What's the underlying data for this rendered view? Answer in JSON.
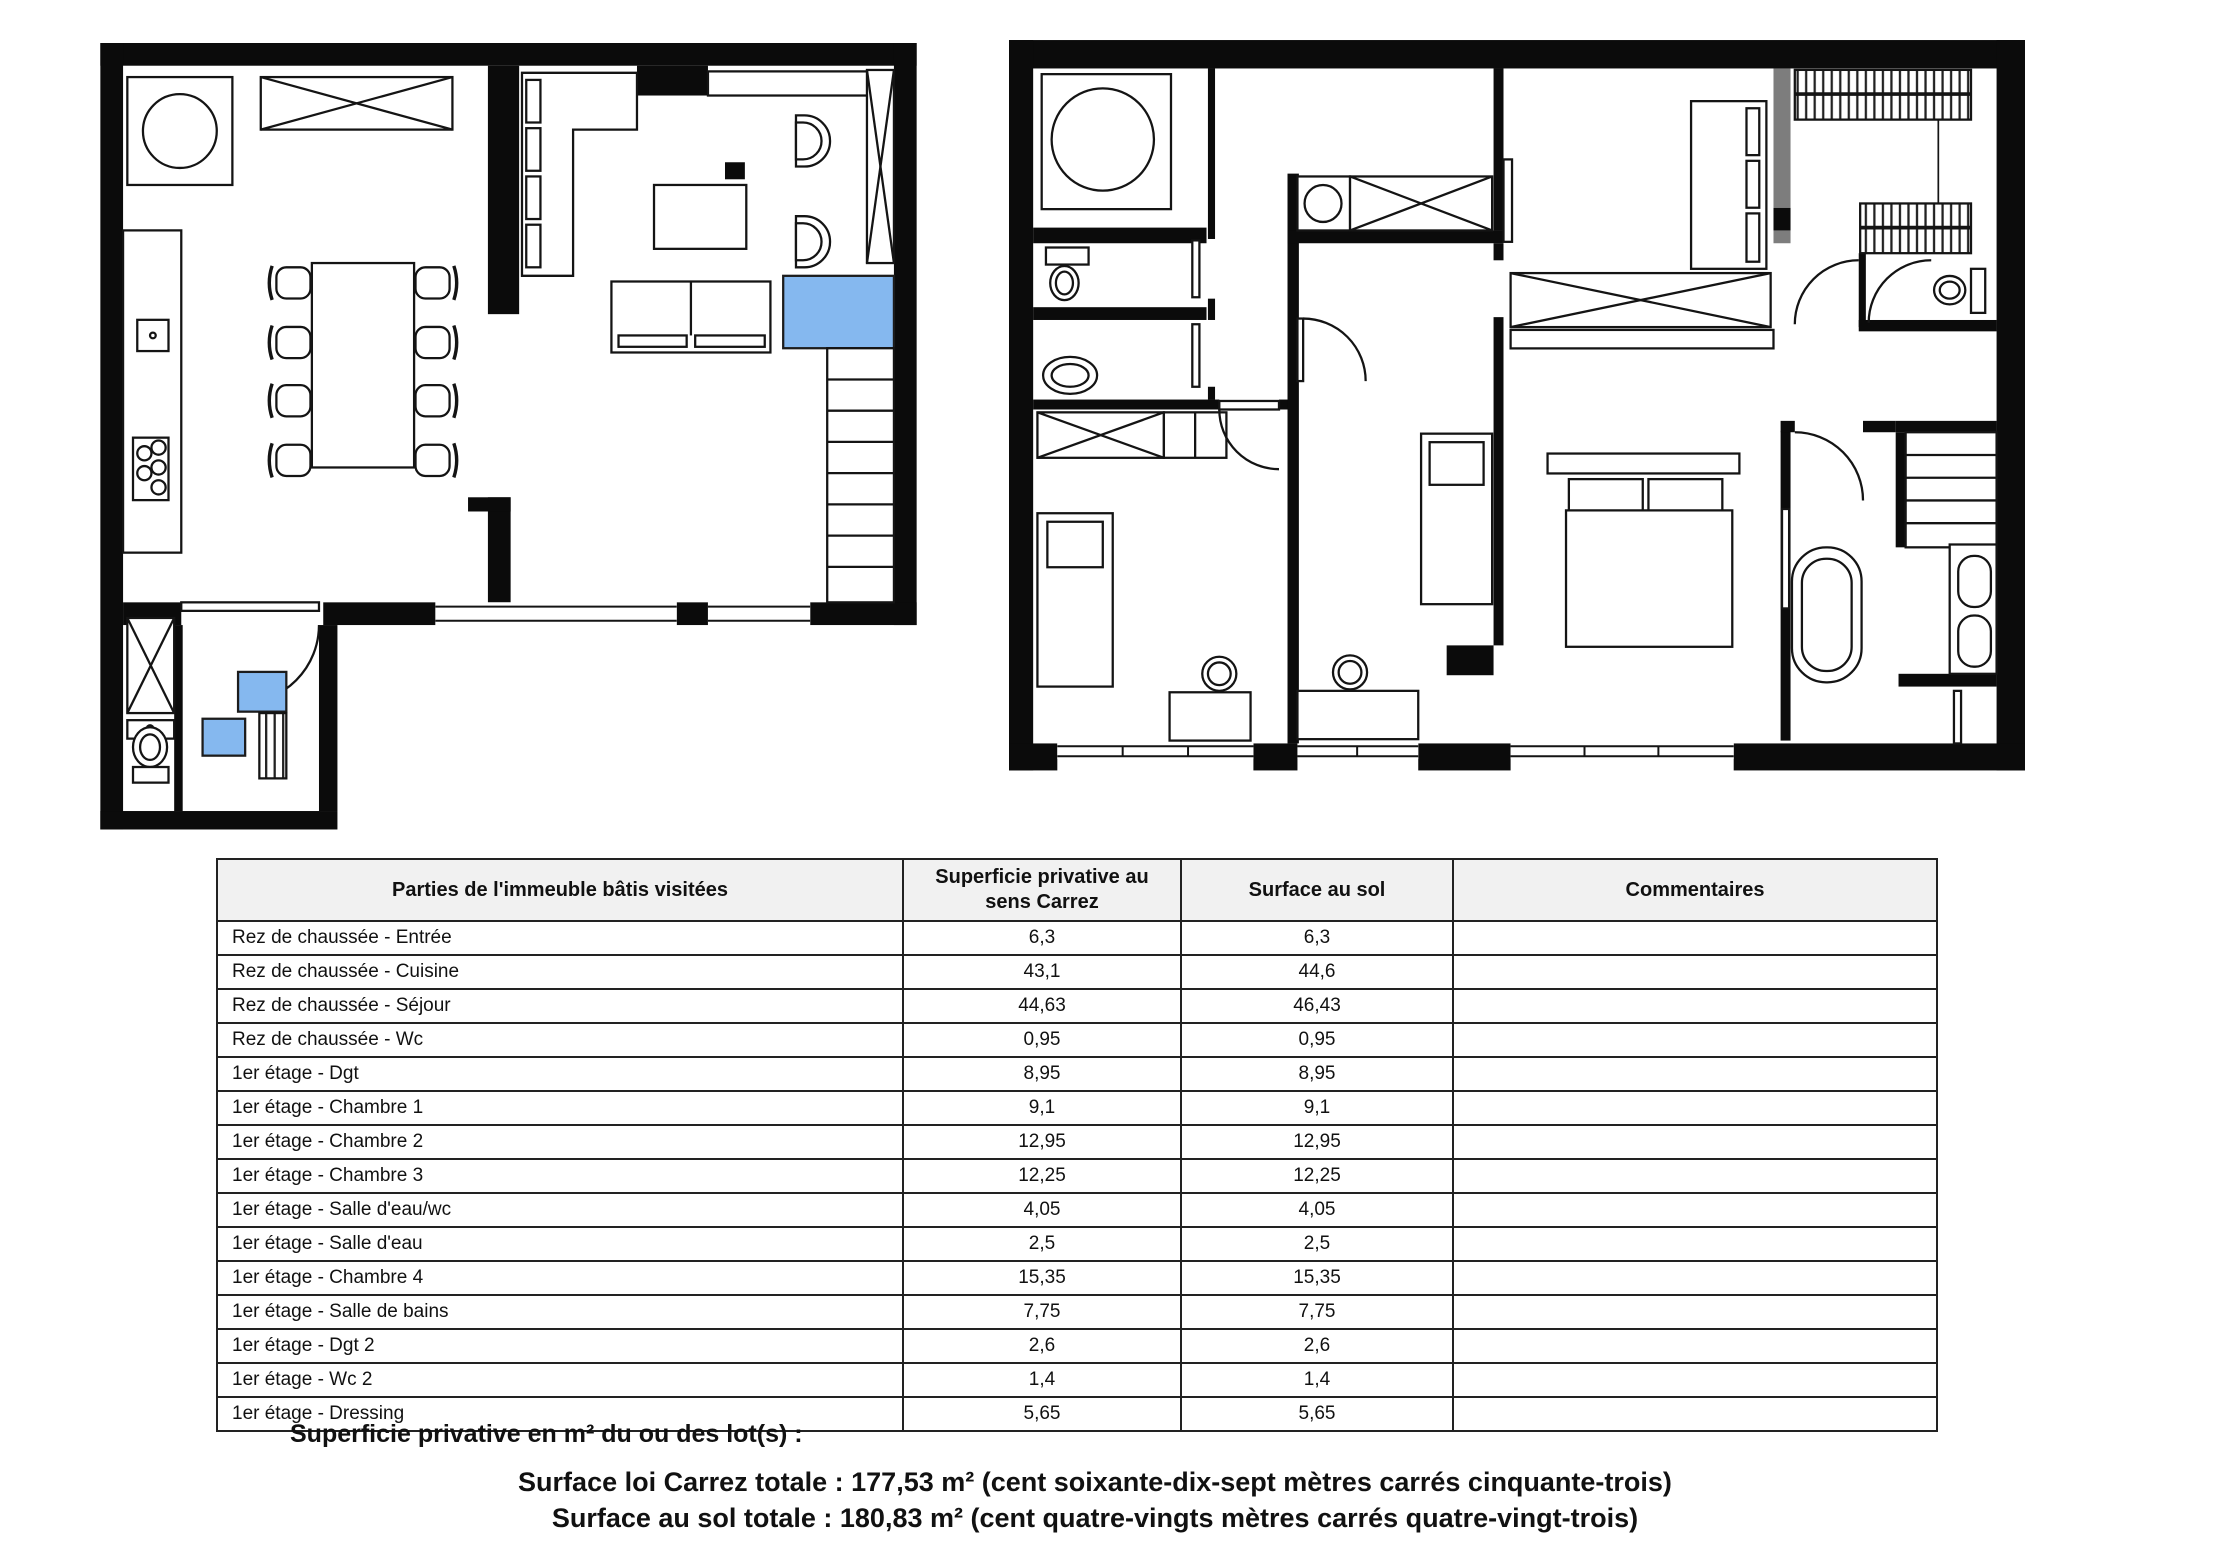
{
  "document": {
    "kind": "floor-plan measurement certificate",
    "plans": {
      "highlight_color": "#85b8ef",
      "wall_color": "#0b0b0b",
      "gray_wall_color": "#7d7d7d"
    },
    "table": {
      "headers": [
        "Parties de l'immeuble bâtis visitées",
        "Superficie privative au sens Carrez",
        "Surface au sol",
        "Commentaires"
      ],
      "rows": [
        {
          "label": "Rez de chaussée - Entrée",
          "carrez": "6,3",
          "sol": "6,3",
          "comment": ""
        },
        {
          "label": "Rez de chaussée - Cuisine",
          "carrez": "43,1",
          "sol": "44,6",
          "comment": ""
        },
        {
          "label": "Rez de chaussée - Séjour",
          "carrez": "44,63",
          "sol": "46,43",
          "comment": ""
        },
        {
          "label": "Rez de chaussée - Wc",
          "carrez": "0,95",
          "sol": "0,95",
          "comment": ""
        },
        {
          "label": "1er étage - Dgt",
          "carrez": "8,95",
          "sol": "8,95",
          "comment": ""
        },
        {
          "label": "1er étage - Chambre 1",
          "carrez": "9,1",
          "sol": "9,1",
          "comment": ""
        },
        {
          "label": "1er étage - Chambre 2",
          "carrez": "12,95",
          "sol": "12,95",
          "comment": ""
        },
        {
          "label": "1er étage - Chambre 3",
          "carrez": "12,25",
          "sol": "12,25",
          "comment": ""
        },
        {
          "label": "1er étage - Salle d'eau/wc",
          "carrez": "4,05",
          "sol": "4,05",
          "comment": ""
        },
        {
          "label": "1er étage - Salle d'eau",
          "carrez": "2,5",
          "sol": "2,5",
          "comment": ""
        },
        {
          "label": "1er étage - Chambre 4",
          "carrez": "15,35",
          "sol": "15,35",
          "comment": ""
        },
        {
          "label": "1er étage - Salle de bains",
          "carrez": "7,75",
          "sol": "7,75",
          "comment": ""
        },
        {
          "label": "1er étage - Dgt 2",
          "carrez": "2,6",
          "sol": "2,6",
          "comment": ""
        },
        {
          "label": "1er étage - Wc 2",
          "carrez": "1,4",
          "sol": "1,4",
          "comment": ""
        },
        {
          "label": "1er étage - Dressing",
          "carrez": "5,65",
          "sol": "5,65",
          "comment": ""
        }
      ]
    },
    "footer": {
      "intro": "Superficie privative en m² du ou des lot(s) :",
      "carrez_total": "Surface loi Carrez totale : 177,53 m² (cent soixante-dix-sept mètres carrés cinquante-trois)",
      "sol_total": "Surface au sol totale : 180,83 m² (cent quatre-vingts mètres carrés quatre-vingt-trois)"
    }
  }
}
